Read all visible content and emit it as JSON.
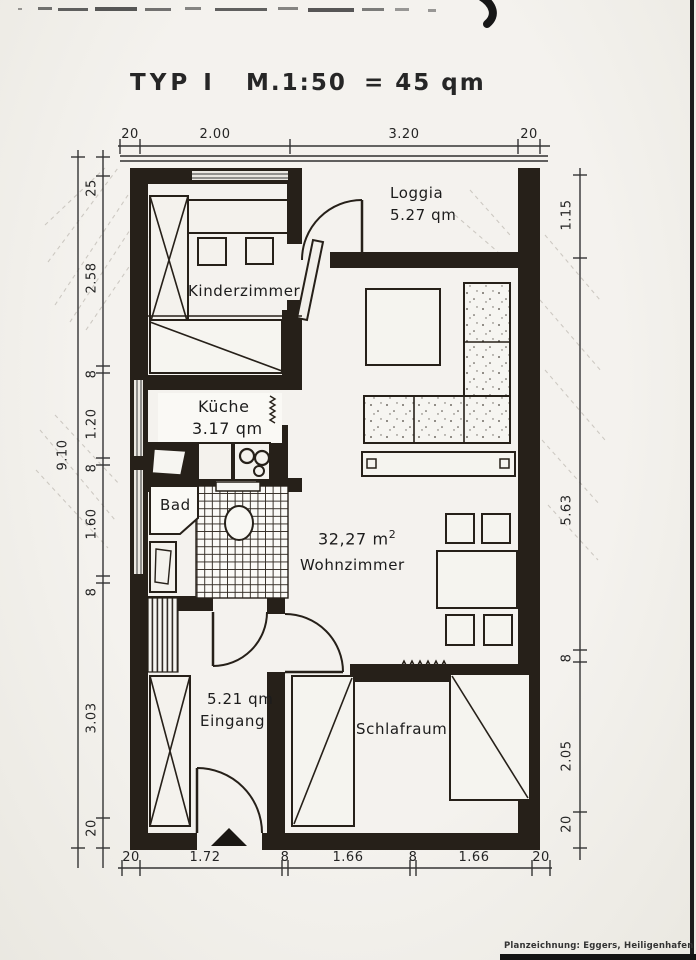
{
  "document": {
    "title": {
      "type_label": "TYP I",
      "scale_label": "M.1:50",
      "area_label": "= 45 qm"
    },
    "credit": "Planzeichnung: Eggers, Heiligenhafen"
  },
  "rooms": {
    "loggia": {
      "name": "Loggia",
      "area": "5.27 qm"
    },
    "kinderzimmer": {
      "name": "Kinderzimmer"
    },
    "kueche": {
      "name": "Küche",
      "area": "3.17 qm"
    },
    "bad": {
      "name": "Bad"
    },
    "wohnzimmer": {
      "name": "Wohnzimmer",
      "area_value": "32,27 m",
      "area_exponent": "2"
    },
    "eingang": {
      "name": "Eingang",
      "area": "5.21 qm"
    },
    "schlafraum": {
      "name": "Schlafraum"
    }
  },
  "dimensions": {
    "top": [
      "20",
      "2.00",
      "3.20",
      "20"
    ],
    "bottom": [
      "20",
      "1.72",
      "8",
      "1.66",
      "8",
      "1.66",
      "20"
    ],
    "left_outer_total": "9.10",
    "left": [
      "25",
      "2.58",
      "8",
      "1.20",
      "8",
      "1.60",
      "8",
      "3.03",
      "20"
    ],
    "right": [
      "1.15",
      "5.63",
      "8",
      "2.05",
      "20"
    ]
  },
  "colors": {
    "ink": "#262019",
    "paper": "#f2f0eb"
  }
}
